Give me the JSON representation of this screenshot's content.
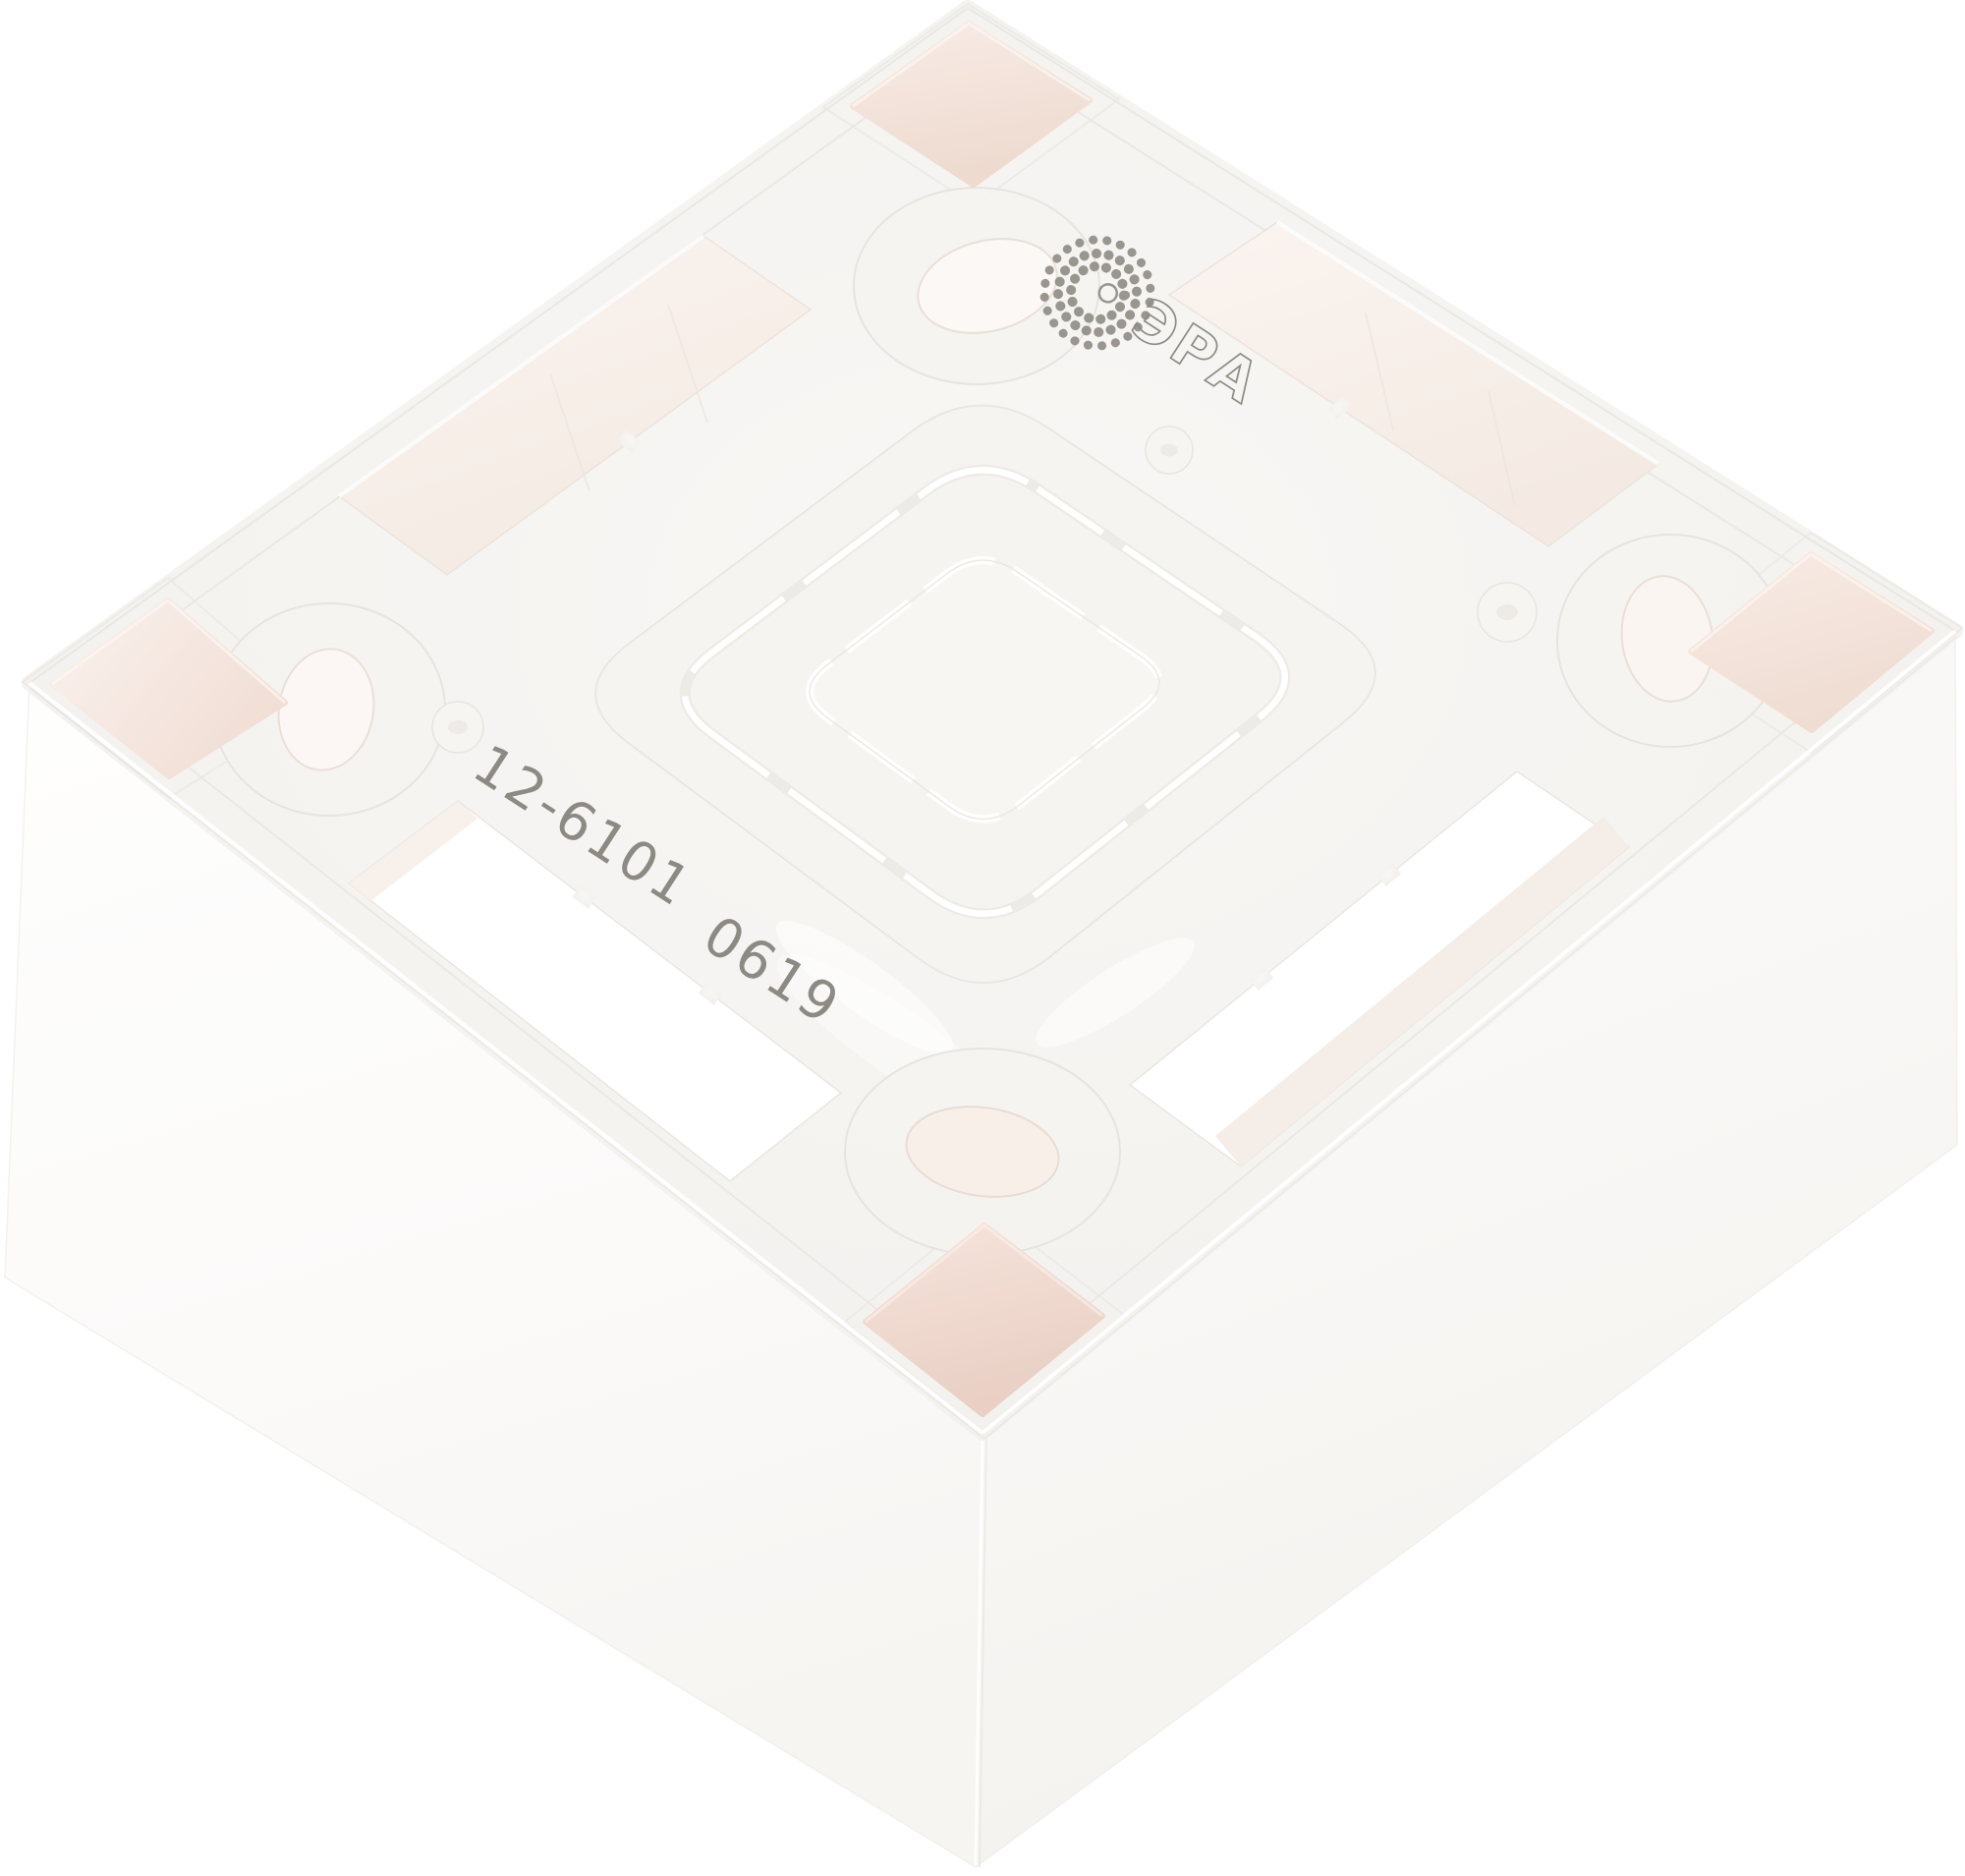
{
  "meta": {
    "alt": "Product photo: white plastic ERA surface-mount wall box, rear view, tilted diamond orientation on white background"
  },
  "product": {
    "brand_logo_text": "ЭРА",
    "article_marking": "12-6101",
    "date_code_marking": "0619"
  },
  "colors": {
    "background": "#ffffff",
    "plastic_top_face": "#f4f2ef",
    "plastic_side_light": "#fdfdfc",
    "plastic_side_shaded": "#f6f4f1",
    "recess_pink": "#eed8cd",
    "recess_pink_deep": "#e9cfc4",
    "through_hole_bright": "#ffffff",
    "mold_line": "#e6e3de",
    "print_ink": "#8d8983"
  }
}
